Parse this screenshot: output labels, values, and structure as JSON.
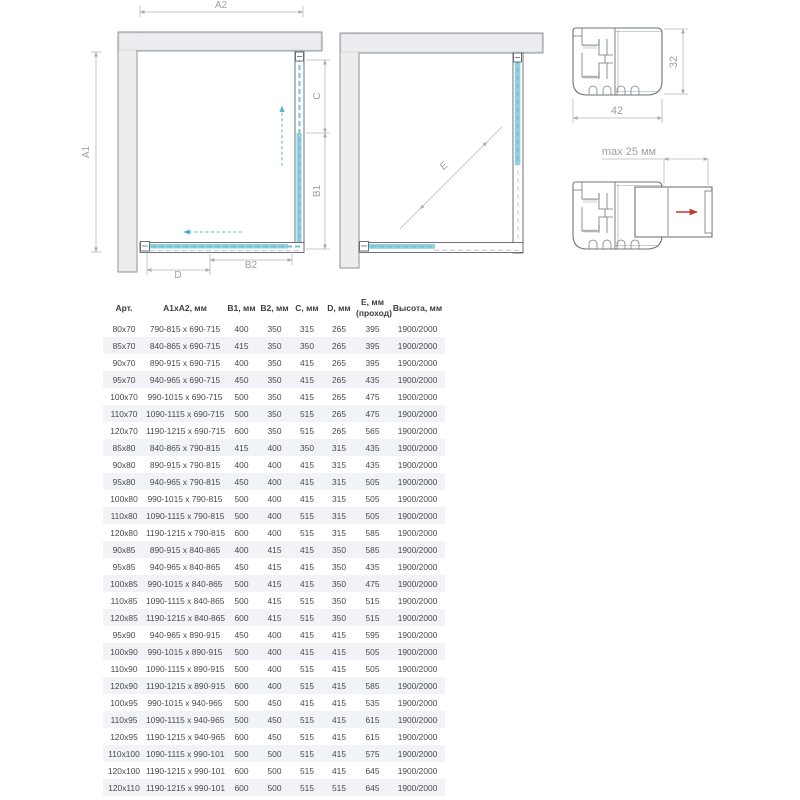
{
  "plan_left": {
    "dim_a1": "A1",
    "dim_a2": "A2",
    "dim_b1": "B1",
    "dim_b2": "B2",
    "dim_c": "C",
    "dim_d": "D"
  },
  "plan_right": {
    "dim_e": "E"
  },
  "profiles": {
    "dim_width": "42",
    "dim_height": "32",
    "dim_max_extension": "max 25 мм"
  },
  "colors": {
    "glass_blue": "#92d0de",
    "glass_dash_blue": "#74c3d6",
    "wall_gray": "#ebedef",
    "frame_dark": "#5f6569",
    "dimension_gray": "#a7acb1",
    "arrow_blue": "#55b1cb",
    "arrow_red": "#c23b2e",
    "row_stripe": "#f2f3f7",
    "table_text": "#46494d"
  },
  "table": {
    "headers": [
      "Арт.",
      "A1xA2, мм",
      "B1, мм",
      "B2, мм",
      "C, мм",
      "D, мм",
      "E, мм\n(проход)",
      "Высота, мм"
    ],
    "rows": [
      [
        "80x70",
        "790-815 x 690-715",
        "400",
        "350",
        "315",
        "265",
        "395",
        "1900/2000"
      ],
      [
        "85x70",
        "840-865 x 690-715",
        "415",
        "350",
        "350",
        "265",
        "395",
        "1900/2000"
      ],
      [
        "90x70",
        "890-915 x 690-715",
        "400",
        "350",
        "415",
        "265",
        "395",
        "1900/2000"
      ],
      [
        "95x70",
        "940-965 x 690-715",
        "450",
        "350",
        "415",
        "265",
        "435",
        "1900/2000"
      ],
      [
        "100x70",
        "990-1015 x 690-715",
        "500",
        "350",
        "415",
        "265",
        "475",
        "1900/2000"
      ],
      [
        "110x70",
        "1090-1115 x 690-715",
        "500",
        "350",
        "515",
        "265",
        "475",
        "1900/2000"
      ],
      [
        "120x70",
        "1190-1215 x 690-715",
        "600",
        "350",
        "515",
        "265",
        "565",
        "1900/2000"
      ],
      [
        "85x80",
        "840-865 x 790-815",
        "415",
        "400",
        "350",
        "315",
        "435",
        "1900/2000"
      ],
      [
        "90x80",
        "890-915 x 790-815",
        "400",
        "400",
        "415",
        "315",
        "435",
        "1900/2000"
      ],
      [
        "95x80",
        "940-965 x 790-815",
        "450",
        "400",
        "415",
        "315",
        "505",
        "1900/2000"
      ],
      [
        "100x80",
        "990-1015 x 790-815",
        "500",
        "400",
        "415",
        "315",
        "505",
        "1900/2000"
      ],
      [
        "110x80",
        "1090-1115 x 790-815",
        "500",
        "400",
        "515",
        "315",
        "505",
        "1900/2000"
      ],
      [
        "120x80",
        "1190-1215 x 790-815",
        "600",
        "400",
        "515",
        "315",
        "585",
        "1900/2000"
      ],
      [
        "90x85",
        "890-915 x 840-865",
        "400",
        "415",
        "415",
        "350",
        "585",
        "1900/2000"
      ],
      [
        "95x85",
        "940-965 x 840-865",
        "450",
        "415",
        "415",
        "350",
        "435",
        "1900/2000"
      ],
      [
        "100x85",
        "990-1015 x 840-865",
        "500",
        "415",
        "415",
        "350",
        "475",
        "1900/2000"
      ],
      [
        "110x85",
        "1090-1115 x 840-865",
        "500",
        "415",
        "515",
        "350",
        "515",
        "1900/2000"
      ],
      [
        "120x85",
        "1190-1215 x 840-865",
        "600",
        "415",
        "515",
        "350",
        "515",
        "1900/2000"
      ],
      [
        "95x90",
        "940-965 x 890-915",
        "450",
        "400",
        "415",
        "415",
        "595",
        "1900/2000"
      ],
      [
        "100x90",
        "990-1015 x 890-915",
        "500",
        "400",
        "415",
        "415",
        "505",
        "1900/2000"
      ],
      [
        "110x90",
        "1090-1115 x 890-915",
        "500",
        "400",
        "515",
        "415",
        "505",
        "1900/2000"
      ],
      [
        "120x90",
        "1190-1215 x 890-915",
        "600",
        "400",
        "515",
        "415",
        "585",
        "1900/2000"
      ],
      [
        "100x95",
        "990-1015 x 940-965",
        "500",
        "450",
        "415",
        "415",
        "535",
        "1900/2000"
      ],
      [
        "110x95",
        "1090-1115 x 940-965",
        "500",
        "450",
        "515",
        "415",
        "615",
        "1900/2000"
      ],
      [
        "120x95",
        "1190-1215 x 940-965",
        "600",
        "450",
        "515",
        "415",
        "615",
        "1900/2000"
      ],
      [
        "110x100",
        "1090-1115 x 990-1015",
        "500",
        "500",
        "515",
        "415",
        "575",
        "1900/2000"
      ],
      [
        "120x100",
        "1190-1215 x 990-1015",
        "600",
        "500",
        "515",
        "415",
        "645",
        "1900/2000"
      ],
      [
        "120x110",
        "1190-1215 x 990-1015",
        "600",
        "500",
        "515",
        "515",
        "645",
        "1900/2000"
      ]
    ]
  }
}
